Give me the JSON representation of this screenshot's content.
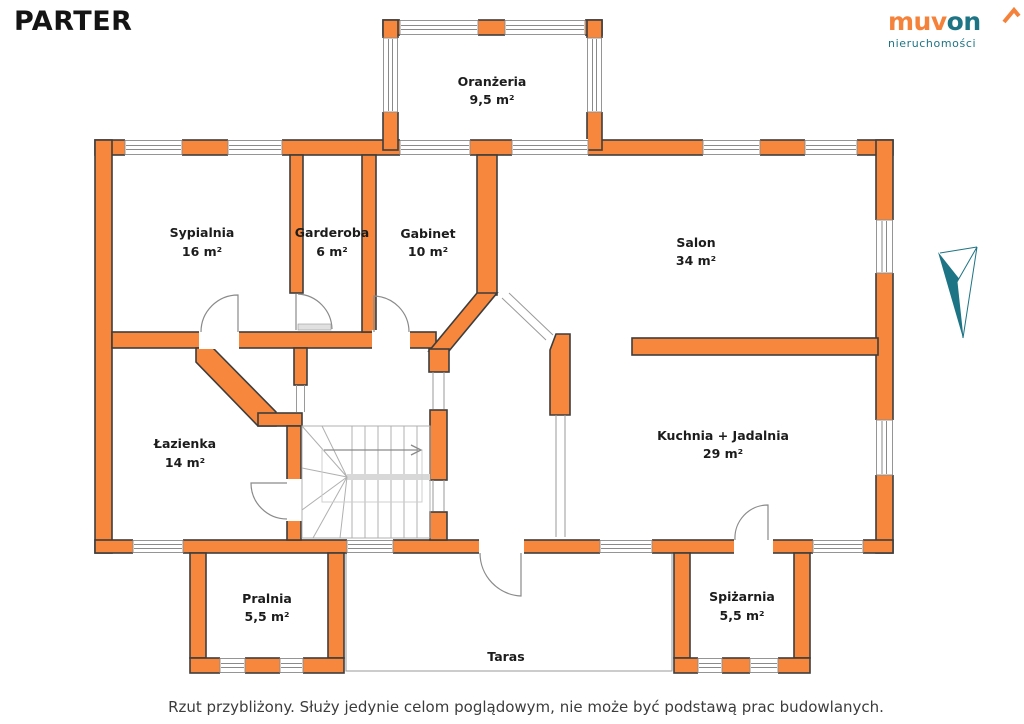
{
  "header": {
    "title": "PARTER"
  },
  "logo": {
    "brand_part_orange": "muv",
    "brand_part_teal": "on",
    "tagline": "nieruchomości",
    "orange": "#f5823a",
    "teal": "#1d7484"
  },
  "rooms": [
    {
      "id": "oranzeria",
      "name": "Oranżeria",
      "area": "9,5 m²"
    },
    {
      "id": "sypialnia",
      "name": "Sypialnia",
      "area": "16 m²"
    },
    {
      "id": "garderoba",
      "name": "Garderoba",
      "area": "6 m²"
    },
    {
      "id": "gabinet",
      "name": "Gabinet",
      "area": "10 m²"
    },
    {
      "id": "salon",
      "name": "Salon",
      "area": "34 m²"
    },
    {
      "id": "lazienka",
      "name": "Łazienka",
      "area": "14 m²"
    },
    {
      "id": "kuchnia",
      "name": "Kuchnia + Jadalnia",
      "area": "29 m²"
    },
    {
      "id": "pralnia",
      "name": "Pralnia",
      "area": "5,5 m²"
    },
    {
      "id": "spizarnia",
      "name": "Spiżarnia",
      "area": "5,5 m²"
    },
    {
      "id": "taras",
      "name": "Taras",
      "area": ""
    }
  ],
  "footer": {
    "disclaimer": "Rzut przybliżony. Służy jedynie celom poglądowym, nie może być podstawą prac budowlanych."
  },
  "colors": {
    "wall_fill": "#f6873c",
    "wall_outline": "#3d3d3d",
    "thin_line": "#9a9a9a",
    "compass_teal": "#1d7484"
  }
}
